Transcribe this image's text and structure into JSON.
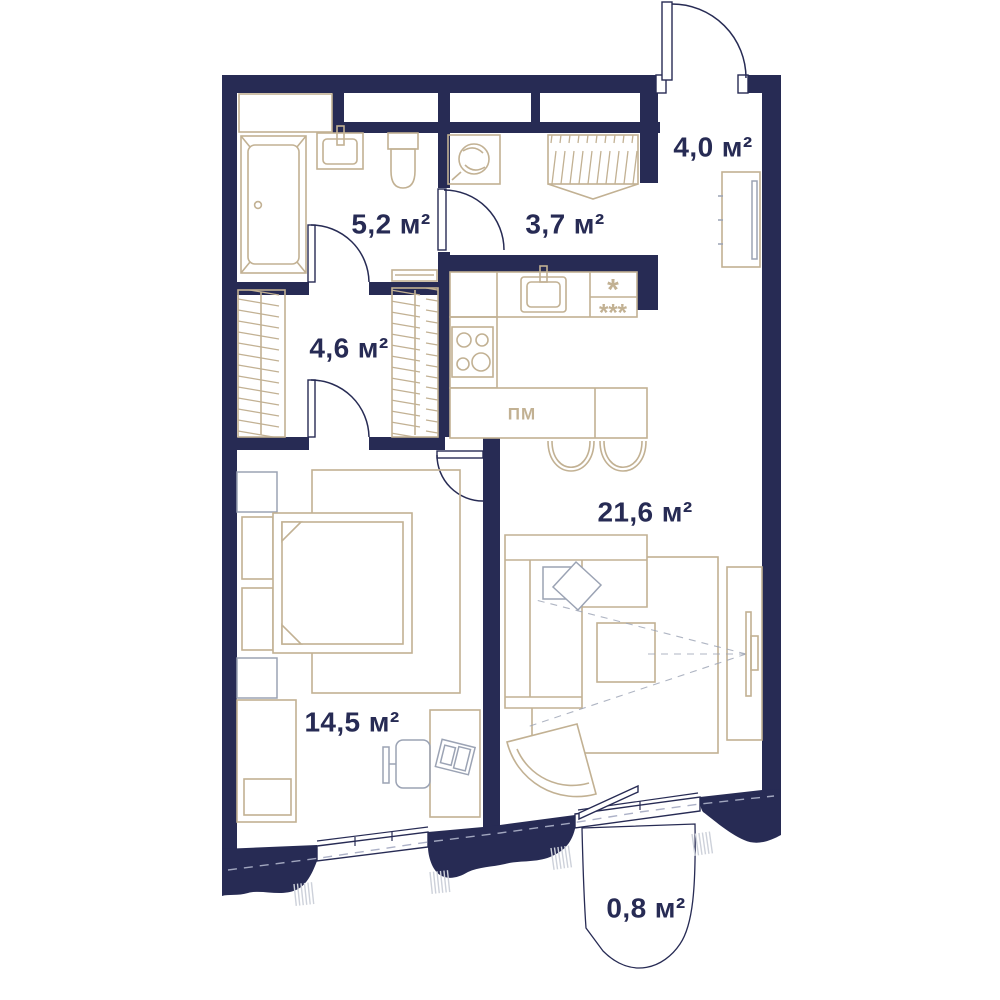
{
  "colors": {
    "wall": "#272b54",
    "furniture": "#c2b193",
    "secondary": "#9ba3b4",
    "hatch": "#cdd1da",
    "dash": "#a8adc4",
    "bg": "#ffffff"
  },
  "plan": {
    "rooms": {
      "hall": "4,0 м²",
      "bathroom": "5,2 м²",
      "corridor": "3,7 м²",
      "wardrobe": "4,6 м²",
      "living": "21,6 м²",
      "bedroom": "14,5 м²",
      "balcony": "0,8 м²"
    },
    "markers": {
      "dishwasher": "ПМ",
      "fridge_top": "*",
      "fridge_bottom": "***"
    }
  }
}
